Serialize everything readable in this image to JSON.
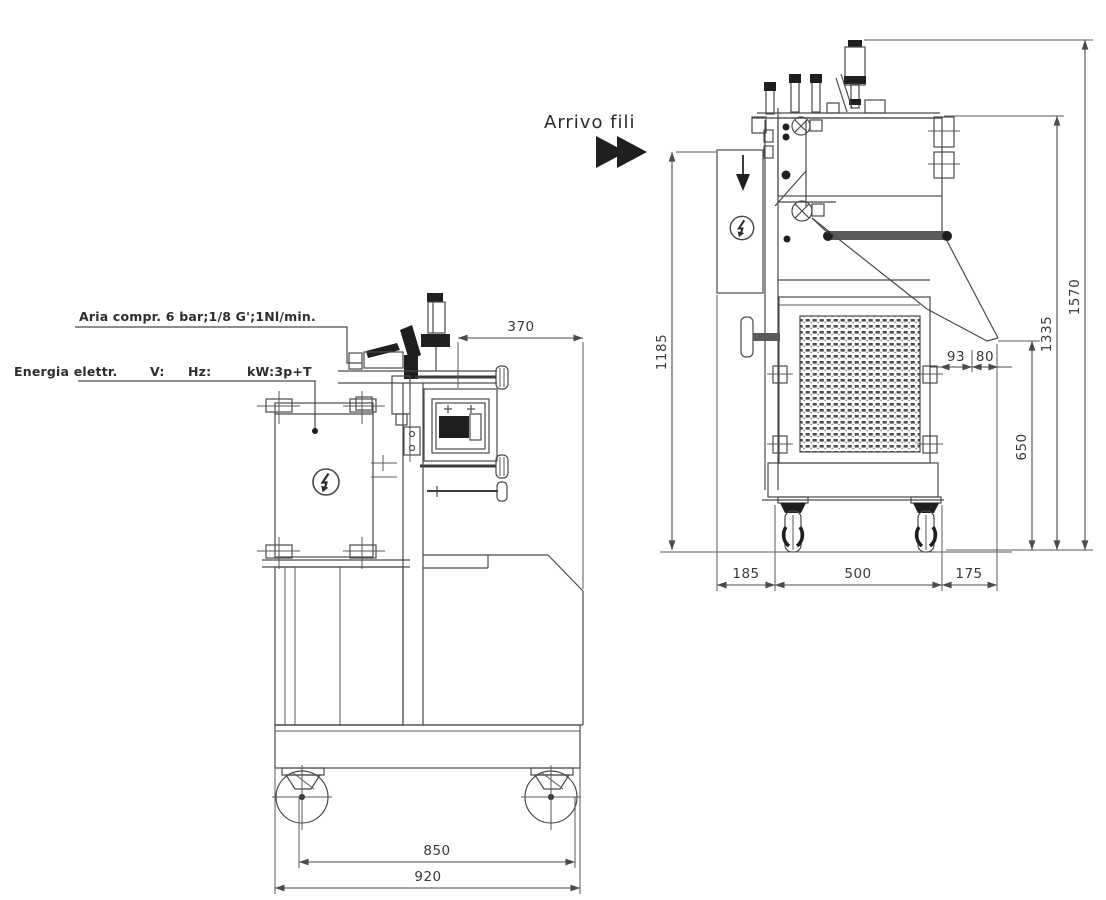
{
  "annotations": {
    "arrivo_fili": "Arrivo fili",
    "aria_compr": "Aria compr. 6 bar;1/8 G';1Nl/min.",
    "energia_elettr": "Energia elettr.",
    "volt": "V:",
    "hertz": "Hz:",
    "kilowatt": "kW:3p+T"
  },
  "front_view": {
    "dim_370": "370",
    "dim_850": "850",
    "dim_920": "920"
  },
  "side_view": {
    "dim_1185": "1185",
    "dim_93": "93",
    "dim_80": "80",
    "dim_650": "650",
    "dim_1335": "1335",
    "dim_1570": "1570",
    "dim_185": "185",
    "dim_500": "500",
    "dim_175": "175"
  },
  "icons": {
    "electric_hazard": "circled-lightning-bolt",
    "wire_feed_arrow": "double-right-arrowheads",
    "feed_direction_arrow": "filled-down-arrow"
  },
  "colors": {
    "line": "#4a4a4a",
    "dark_fill": "#1f1f1f",
    "dim_text": "#383838",
    "background": "#ffffff"
  }
}
